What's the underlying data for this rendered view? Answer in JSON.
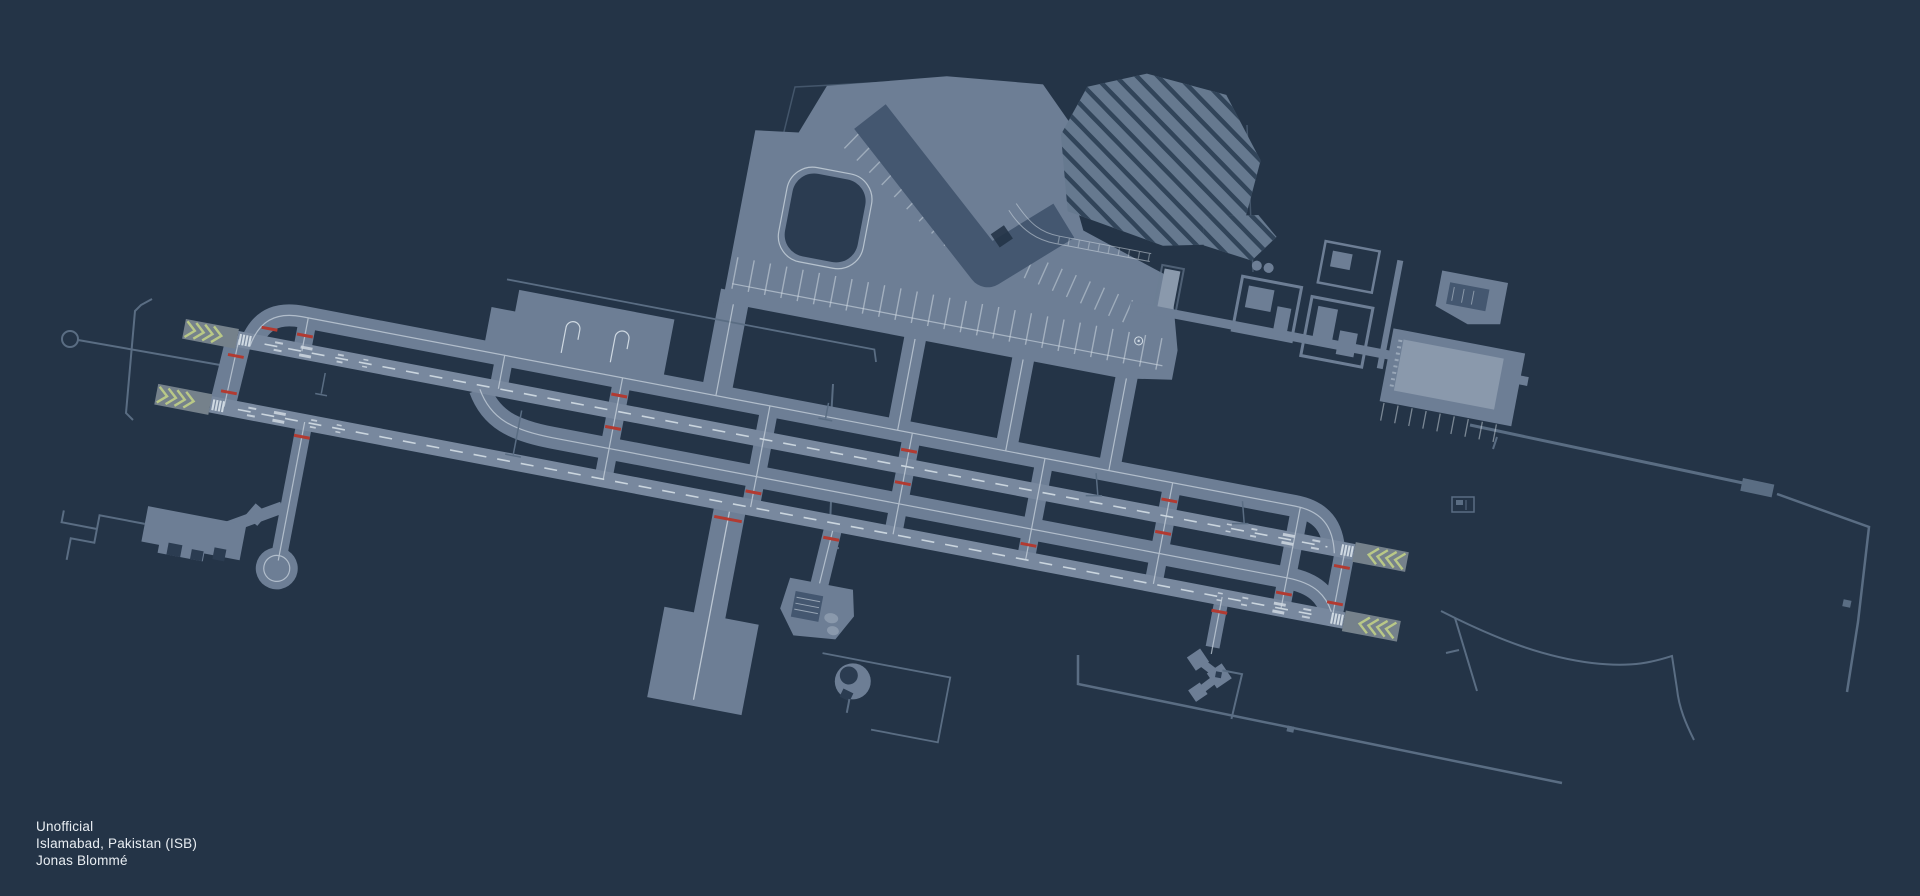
{
  "caption": {
    "line1": "Unofficial",
    "line2": "Islamabad, Pakistan (ISB)",
    "line3": "Jonas Blommé"
  },
  "map": {
    "type": "airport-ground-layout",
    "airport_city": "Islamabad",
    "airport_country": "Pakistan",
    "airport_code": "ISB",
    "credit": "Jonas Blommé",
    "status": "Unofficial",
    "features": {
      "runways": 2,
      "displaced_threshold_chevron_pads": 4,
      "parallel_taxiways": 2,
      "terminal_shape": "V-shaped pier terminal with apron stands",
      "landside": "striped parking lots and curb roads",
      "hold_short_marks": "red dashes on runway-entry taxiways"
    }
  },
  "palette": {
    "bg": "#243447",
    "pav": "#6d7e95",
    "rwy": "#78889e",
    "term": "#445770",
    "island": "#2b3c51",
    "slab": "#8a99ac",
    "lot": "#66798f",
    "lotstripe": "#314459",
    "mk": "#cfd9e2",
    "red": "#b23a31",
    "chev": "#b9c887",
    "chevpad": "#75818b",
    "road": "#5a6d83",
    "fence": "#44566b",
    "text": "#e9eef3"
  }
}
